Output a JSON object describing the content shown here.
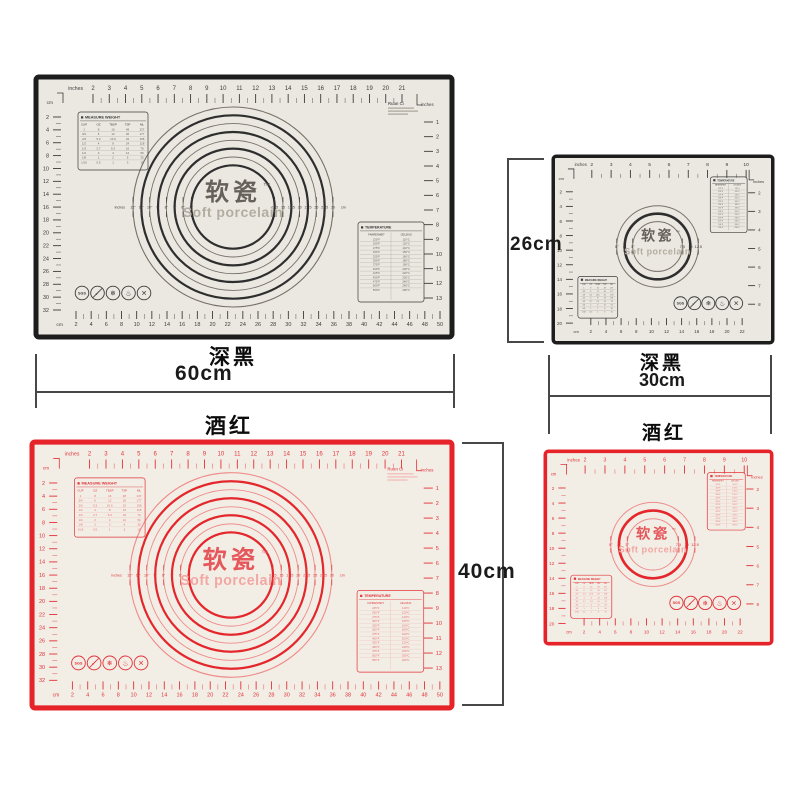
{
  "colors": {
    "black_mat_border": "#1d1d1d",
    "red_mat_border": "#e52329",
    "mat_surface": "#ebe8e1",
    "mat_surface_red": "#f2eee6",
    "dimension_line": "#474747",
    "annotation_text": "#0c0c0c"
  },
  "products": [
    {
      "key": "large-black",
      "label": "深黑",
      "dimension": "60cm"
    },
    {
      "key": "small-black",
      "label": "深黑",
      "width": "30cm",
      "height": "26cm"
    },
    {
      "key": "large-red",
      "label": "酒红",
      "height": "40cm"
    },
    {
      "key": "small-red",
      "label": "酒红"
    }
  ],
  "mat": {
    "brand": {
      "cn": "软瓷",
      "tm": "™",
      "en": "Soft porcelain",
      "corner_print": "Ruan Ci"
    },
    "rulers": {
      "large": {
        "top": {
          "unit": "inches",
          "values": [
            2,
            3,
            4,
            5,
            6,
            7,
            8,
            9,
            10,
            11,
            12,
            13,
            14,
            15,
            16,
            17,
            18,
            19,
            20,
            21
          ]
        },
        "left": {
          "unit": "cm",
          "values": [
            2,
            4,
            6,
            8,
            10,
            12,
            14,
            16,
            18,
            20,
            22,
            24,
            26,
            28,
            30,
            32
          ]
        },
        "right": {
          "unit": "inches",
          "values": [
            1,
            2,
            3,
            4,
            5,
            6,
            7,
            8,
            9,
            10,
            11,
            12,
            13
          ]
        },
        "bottom": {
          "unit": "cm",
          "values": [
            2,
            4,
            6,
            8,
            10,
            12,
            14,
            16,
            18,
            20,
            22,
            24,
            26,
            28,
            30,
            32,
            34,
            36,
            38,
            40,
            42,
            44,
            46,
            48,
            50
          ]
        }
      },
      "small": {
        "top": {
          "unit": "inches",
          "values": [
            2,
            3,
            4,
            5,
            6,
            7,
            8,
            9,
            10
          ]
        },
        "left": {
          "unit": "cm",
          "values": [
            2,
            4,
            6,
            8,
            10,
            12,
            14,
            16,
            18,
            20
          ]
        },
        "right": {
          "unit": "inches",
          "values": [
            2,
            3,
            4,
            5,
            6,
            7,
            8
          ]
        },
        "bottom": {
          "unit": "cm",
          "values": [
            2,
            4,
            6,
            8,
            10,
            12,
            14,
            16,
            18,
            20,
            22
          ]
        }
      }
    },
    "circles": {
      "large": {
        "left_unit": "inches",
        "left_labels": [
          "12\"",
          "11\"",
          "10\"",
          "9\"",
          "8\"",
          "7\"",
          "6\"",
          "5\""
        ],
        "right_labels": [
          "12.5",
          "15",
          "17.5",
          "20",
          "22.5",
          "25",
          "27.5",
          "30"
        ],
        "right_unit": "cm"
      },
      "small": {
        "left_unit": "",
        "left_labels": [
          "5\"",
          "4\"",
          "3\""
        ],
        "right_labels": [
          "7.5",
          "10",
          "12.5"
        ],
        "right_unit": ""
      }
    },
    "measure_table": {
      "title": "MEASURE WEIGHT",
      "headers": [
        "CUP",
        "OZ",
        "TBSP",
        "TSP",
        "ML"
      ],
      "rows": [
        [
          "1",
          "8",
          "16",
          "48",
          "237"
        ],
        [
          "3/4",
          "6",
          "12",
          "36",
          "177"
        ],
        [
          "2/3",
          "5.3",
          "10.6",
          "32",
          "158"
        ],
        [
          "1/2",
          "4",
          "8",
          "24",
          "118"
        ],
        [
          "1/3",
          "2.7",
          "5.3",
          "16",
          "79"
        ],
        [
          "1/4",
          "2",
          "4",
          "12",
          "59"
        ],
        [
          "1/8",
          "1",
          "2",
          "6",
          "30"
        ],
        [
          "1/16",
          "0.5",
          "1",
          "3",
          "15"
        ]
      ]
    },
    "temperature_table": {
      "title": "TEMPERATURE",
      "headers": [
        "FAHRENHEIT",
        "CELSIUS"
      ],
      "rows": [
        [
          "225°F",
          "110°C"
        ],
        [
          "250°F",
          "120°C"
        ],
        [
          "275°F",
          "140°C"
        ],
        [
          "300°F",
          "150°C"
        ],
        [
          "325°F",
          "160°C"
        ],
        [
          "350°F",
          "180°C"
        ],
        [
          "375°F",
          "190°C"
        ],
        [
          "400°F",
          "200°C"
        ],
        [
          "425°F",
          "220°C"
        ],
        [
          "450°F",
          "230°C"
        ],
        [
          "475°F",
          "240°C"
        ],
        [
          "500°F",
          "260°C"
        ],
        [
          "550°F",
          "290°C"
        ]
      ]
    },
    "icons": [
      {
        "name": "sgs-badge-icon",
        "glyph": "SGS"
      },
      {
        "name": "food-safe-icon",
        "glyph": "✓"
      },
      {
        "name": "freezer-safe-icon",
        "glyph": "❄"
      },
      {
        "name": "heat-resistant-icon",
        "glyph": "♨"
      },
      {
        "name": "no-knife-icon",
        "glyph": "✕"
      }
    ]
  }
}
